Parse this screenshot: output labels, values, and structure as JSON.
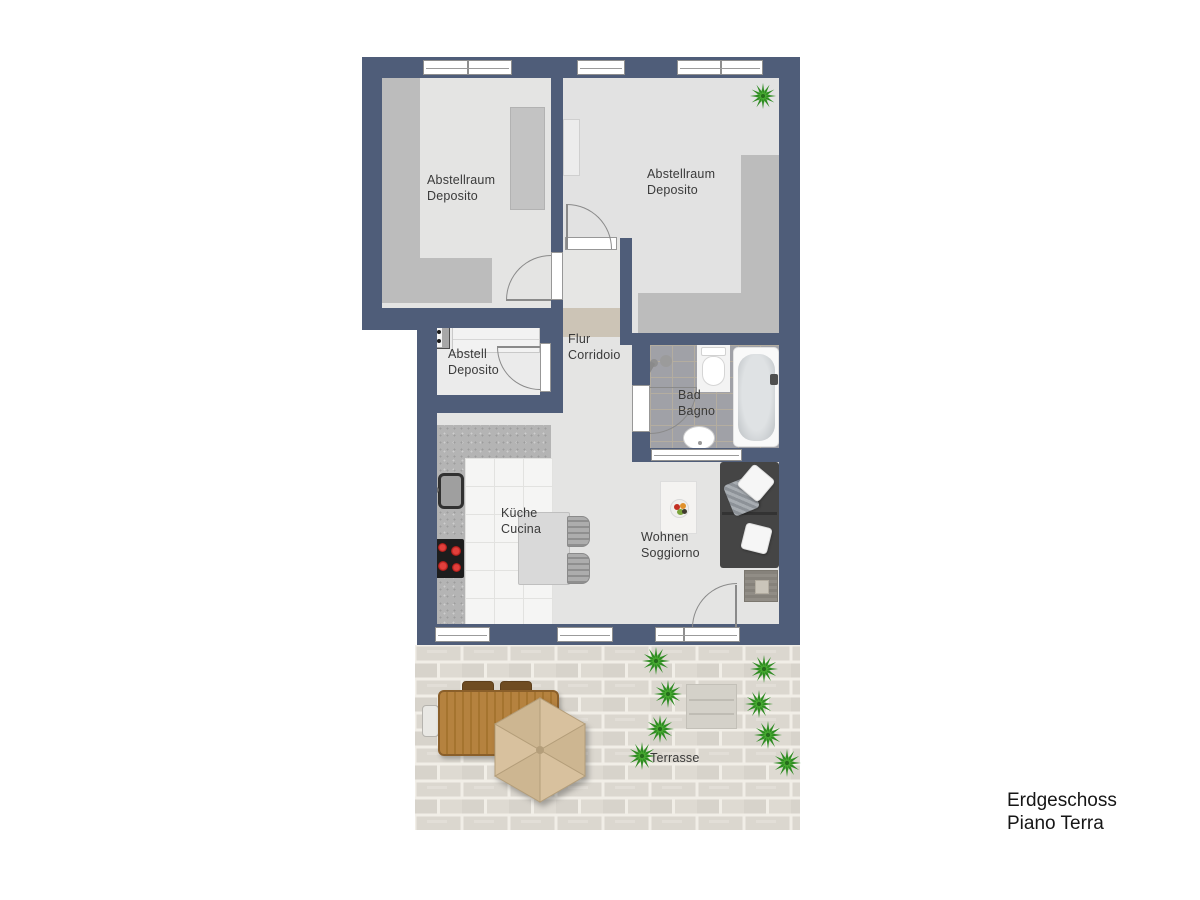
{
  "rooms": {
    "storage_left": {
      "line1": "Abstellraum",
      "line2": "Deposito"
    },
    "storage_right": {
      "line1": "Abstellraum",
      "line2": "Deposito"
    },
    "storage_small": {
      "line1": "Abstell",
      "line2": "Deposito"
    },
    "hallway": {
      "line1": "Flur",
      "line2": "Corridoio"
    },
    "bathroom": {
      "line1": "Bad",
      "line2": "Bagno"
    },
    "kitchen": {
      "line1": "Küche",
      "line2": "Cucina"
    },
    "living_room": {
      "line1": "Wohnen",
      "line2": "Soggiorno"
    },
    "terrace": {
      "line1": "Terrasse"
    }
  },
  "floor_label": {
    "line1": "Erdgeschoss",
    "line2": "Piano Terra"
  },
  "colors": {
    "wall": "#4f5d79",
    "room_floor": "#e4e4e3",
    "closet_shade": "#bcbcbc",
    "corridor_beige": "#ccc4b6",
    "bath_tile": "#a0a1a7",
    "terrace_paver": "#dbd7cf",
    "terrace_mortar": "#f1eee7",
    "plant_green_dark": "#2e8b22",
    "plant_green_light": "#4aae33",
    "stove_burner_red": "#d0201d",
    "sofa_charcoal": "#454545",
    "wood_table_brown": "#b5823f",
    "umbrella_tan": "#d8c19e"
  },
  "icons": {
    "plant": "green-starburst-bush",
    "parasol": "hexagon-umbrella",
    "washing_machine": "gray-box-two-dots",
    "stove": "black-cooktop-four-red-burners",
    "kitchen_sink": "dark-rim-basin",
    "bathtub": "rounded-white-tub",
    "toilet": "white-bowl-with-tank",
    "bath_sink": "white-oval-basin",
    "shower": "two-gray-discs",
    "sofa": "charcoal-sofa-white-pillows",
    "fruit_bowl": "bowl-with-colored-fruit",
    "door": "quarter-circle-swing-arc",
    "window": "white-bar-in-wall"
  }
}
